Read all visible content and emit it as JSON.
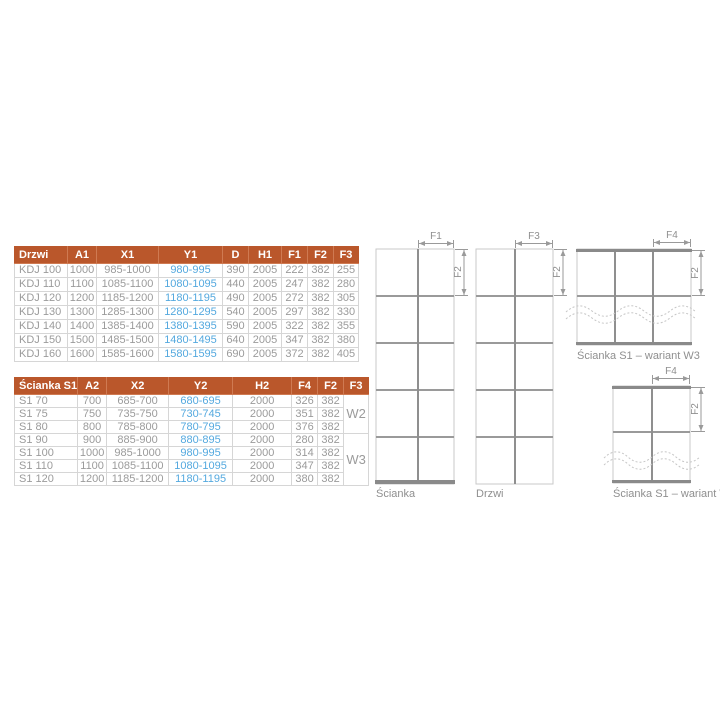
{
  "colors": {
    "header_bg": "#ba572b",
    "header_text": "#ffffff",
    "cell_text": "#9b9b9b",
    "highlight_text": "#54a9df",
    "table_border": "#d6d6d6",
    "diagram_frame": "#c9c9c9",
    "diagram_lines": "#8a8a8a",
    "dimension_lines": "#9a9a9a"
  },
  "doors_table": {
    "headers": [
      "Drzwi",
      "A1",
      "X1",
      "Y1",
      "D",
      "H1",
      "F1",
      "F2",
      "F3"
    ],
    "highlight_column": "Y1",
    "rows": [
      [
        "KDJ 100",
        "1000",
        "985-1000",
        "980-995",
        "390",
        "2005",
        "222",
        "382",
        "255"
      ],
      [
        "KDJ 110",
        "1100",
        "1085-1100",
        "1080-1095",
        "440",
        "2005",
        "247",
        "382",
        "280"
      ],
      [
        "KDJ 120",
        "1200",
        "1185-1200",
        "1180-1195",
        "490",
        "2005",
        "272",
        "382",
        "305"
      ],
      [
        "KDJ 130",
        "1300",
        "1285-1300",
        "1280-1295",
        "540",
        "2005",
        "297",
        "382",
        "330"
      ],
      [
        "KDJ 140",
        "1400",
        "1385-1400",
        "1380-1395",
        "590",
        "2005",
        "322",
        "382",
        "355"
      ],
      [
        "KDJ 150",
        "1500",
        "1485-1500",
        "1480-1495",
        "640",
        "2005",
        "347",
        "382",
        "380"
      ],
      [
        "KDJ 160",
        "1600",
        "1585-1600",
        "1580-1595",
        "690",
        "2005",
        "372",
        "382",
        "405"
      ]
    ]
  },
  "walls_table": {
    "headers": [
      "Ścianka S1",
      "A2",
      "X2",
      "Y2",
      "H2",
      "F4",
      "F2",
      "F3"
    ],
    "highlight_column": "Y2",
    "rows": [
      [
        "S1 70",
        "700",
        "685-700",
        "680-695",
        "2000",
        "326",
        "382"
      ],
      [
        "S1 75",
        "750",
        "735-750",
        "730-745",
        "2000",
        "351",
        "382"
      ],
      [
        "S1 80",
        "800",
        "785-800",
        "780-795",
        "2000",
        "376",
        "382"
      ],
      [
        "S1 90",
        "900",
        "885-900",
        "880-895",
        "2000",
        "280",
        "382"
      ],
      [
        "S1 100",
        "1000",
        "985-1000",
        "980-995",
        "2000",
        "314",
        "382"
      ],
      [
        "S1 110",
        "1100",
        "1085-1100",
        "1080-1095",
        "2000",
        "347",
        "382"
      ],
      [
        "S1 120",
        "1200",
        "1185-1200",
        "1180-1195",
        "2000",
        "380",
        "382"
      ]
    ],
    "variant_groups": [
      {
        "label": "W2",
        "rows": 3
      },
      {
        "label": "W3",
        "rows": 4
      }
    ]
  },
  "diagrams": {
    "scianka": {
      "label": "Ścianka",
      "top_dim": "F1",
      "side_dim": "F2"
    },
    "drzwi": {
      "label": "Drzwi",
      "top_dim": "F3",
      "side_dim": "F2"
    },
    "w3": {
      "label": "Ścianka S1 – wariant W3",
      "top_dim": "F4",
      "side_dim": "F2"
    },
    "w2": {
      "label": "Ścianka S1 – wariant W2",
      "top_dim": "F4",
      "side_dim": "F2"
    }
  }
}
